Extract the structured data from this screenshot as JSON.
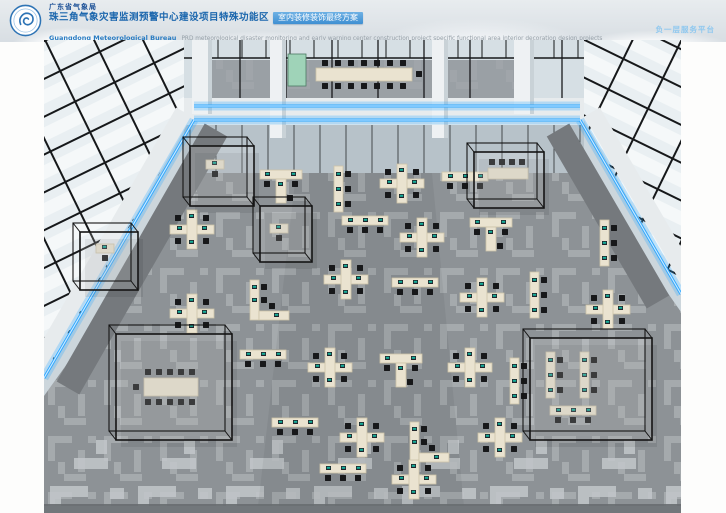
{
  "header": {
    "org": "广东省气象局",
    "title": "珠三角气象灾害监测预警中心建设项目特殊功能区",
    "title_tag": "室内装修装饰最终方案",
    "subtitle_bold": "Guangdong Meteorological Bureau",
    "subtitle_rest": "PRD meteorological disaster monitoring and early warning center construction project specific functional area interior decoration design projects",
    "page_label": "负一层服务平台"
  },
  "colors": {
    "sky1": "#e8ecef",
    "sky2": "#d8dee3",
    "org_blue": "#1a4f96",
    "title_blue": "#1b66ad",
    "tag_bg1": "#6fb1e4",
    "tag_bg2": "#3f8fd2",
    "tag_text": "#ffffff",
    "eng_blue": "#2a7cc2",
    "eng_gray": "#96a0a8",
    "page_label": "#8fc8ef",
    "glass_bg": "#ccd6dc",
    "glass_light": "#e9eff2",
    "railing": "#d6dfe4",
    "wall_glass": "#b7c2c9",
    "frame": "#16181a",
    "fascia": "#e7ebed",
    "walkway": "#75797d",
    "floor": "#8d9296",
    "floor_pattern": "#c2c7ca",
    "mezz_floor": "#9aa0a5",
    "column": "#eef1f3",
    "column_shade": "#c9d2d7",
    "led": "#2fa8ff",
    "led_hi": "#cfeaff",
    "desk": "#eae3d0",
    "desk_edge": "#cdc4a9",
    "chair": "#17181a",
    "screen": "#16ae9a",
    "display_panel": "#9fd3b8",
    "room_frame": "#141414",
    "bottom_edge": "#686d70"
  },
  "scene": {
    "size": {
      "w": 637,
      "h": 473
    },
    "left_wall": "0,0 172,0 150,72 0,338",
    "right_wall": "500,0 637,0 637,252 536,73",
    "mezzanine": {
      "rail": {
        "x": 140,
        "y": 0,
        "w": 400,
        "h": 66
      },
      "floor": {
        "x": 150,
        "y": 20,
        "w": 340,
        "h": 44
      },
      "lower_wall": {
        "x": 140,
        "y": 85,
        "w": 400,
        "h": 48
      },
      "fascia": {
        "x": 140,
        "y": 58,
        "w": 400,
        "h": 30
      },
      "table": {
        "x": 272,
        "y": 28,
        "w": 96,
        "h": 13
      },
      "display": {
        "x": 244,
        "y": 14,
        "w": 18,
        "h": 32
      },
      "columns": [
        {
          "x": 148,
          "y": 0,
          "w": 20,
          "h": 74
        },
        {
          "x": 226,
          "y": 0,
          "w": 16,
          "h": 98
        },
        {
          "x": 388,
          "y": 0,
          "w": 16,
          "h": 98
        },
        {
          "x": 470,
          "y": 0,
          "w": 20,
          "h": 74
        }
      ]
    },
    "floor_poly": "160,133 540,133 637,272 637,466 0,466 0,356",
    "bottom_band": "0,400 637,400 637,466 0,466",
    "aisle": "252,133 388,133 420,466 214,466",
    "walkways": [
      {
        "d": "M172,90 L24,348"
      },
      {
        "d": "M514,90 L614,262"
      }
    ],
    "fascia_paths": [
      {
        "d": "M140,72 L-8,330"
      },
      {
        "d": "M548,72 L648,244"
      }
    ],
    "led_strips": [
      {
        "d": "M150,66 L536,66"
      },
      {
        "d": "M150,80 L536,80"
      },
      {
        "d": "M150,80 L0,338"
      },
      {
        "d": "M536,80 L637,254"
      }
    ],
    "glass_rooms": [
      {
        "x": 146,
        "y": 106,
        "w": 64,
        "h": 60
      },
      {
        "x": 216,
        "y": 166,
        "w": 52,
        "h": 56
      },
      {
        "x": 72,
        "y": 294,
        "w": 116,
        "h": 106
      },
      {
        "x": 486,
        "y": 298,
        "w": 122,
        "h": 102
      },
      {
        "x": 430,
        "y": 112,
        "w": 70,
        "h": 56
      },
      {
        "x": 36,
        "y": 192,
        "w": 58,
        "h": 58
      }
    ],
    "cluster_types": {
      "cross": {
        "desks": [
          [
            0,
            15,
            44,
            9
          ],
          [
            17,
            0,
            10,
            39
          ]
        ],
        "chairs": [
          [
            8,
            8
          ],
          [
            36,
            8
          ],
          [
            8,
            31
          ],
          [
            36,
            31
          ]
        ],
        "monitors": [
          [
            7,
            16
          ],
          [
            32,
            16
          ],
          [
            19,
            4
          ],
          [
            19,
            30
          ]
        ]
      },
      "hrow": {
        "desks": [
          [
            0,
            0,
            46,
            9
          ]
        ],
        "chairs": [
          [
            8,
            14
          ],
          [
            23,
            14
          ],
          [
            38,
            14
          ]
        ],
        "monitors": [
          [
            6,
            2
          ],
          [
            21,
            2
          ],
          [
            36,
            2
          ]
        ]
      },
      "vrow": {
        "desks": [
          [
            0,
            0,
            9,
            46
          ]
        ],
        "chairs": [
          [
            14,
            8
          ],
          [
            14,
            23
          ],
          [
            14,
            38
          ]
        ],
        "monitors": [
          [
            2,
            6
          ],
          [
            2,
            21
          ],
          [
            2,
            36
          ]
        ]
      },
      "trow": {
        "desks": [
          [
            0,
            0,
            42,
            9
          ],
          [
            16,
            9,
            10,
            24
          ]
        ],
        "chairs": [
          [
            7,
            14
          ],
          [
            35,
            14
          ],
          [
            30,
            28
          ]
        ],
        "monitors": [
          [
            5,
            2
          ],
          [
            31,
            2
          ],
          [
            18,
            12
          ]
        ]
      },
      "lshape": {
        "desks": [
          [
            0,
            0,
            9,
            40
          ],
          [
            9,
            31,
            30,
            9
          ]
        ],
        "chairs": [
          [
            14,
            7
          ],
          [
            14,
            20
          ],
          [
            22,
            26
          ]
        ],
        "monitors": [
          [
            2,
            5
          ],
          [
            2,
            18
          ],
          [
            24,
            33
          ]
        ]
      },
      "single": {
        "desks": [
          [
            0,
            0,
            18,
            9
          ]
        ],
        "chairs": [
          [
            9,
            14
          ]
        ],
        "monitors": [
          [
            6,
            1
          ]
        ]
      },
      "conference": {
        "desks": [
          [
            0,
            0,
            54,
            18
          ]
        ],
        "chairs": [
          [
            4,
            -6
          ],
          [
            15,
            -6
          ],
          [
            26,
            -6
          ],
          [
            37,
            -6
          ],
          [
            48,
            -6
          ],
          [
            4,
            24
          ],
          [
            15,
            24
          ],
          [
            26,
            24
          ],
          [
            37,
            24
          ],
          [
            48,
            24
          ],
          [
            -8,
            9
          ]
        ],
        "monitors": []
      },
      "smallconf": {
        "desks": [
          [
            0,
            0,
            40,
            11
          ]
        ],
        "chairs": [
          [
            4,
            -6
          ],
          [
            14,
            -6
          ],
          [
            24,
            -6
          ],
          [
            34,
            -6
          ]
        ],
        "monitors": []
      }
    },
    "desk_clusters": [
      {
        "t": "single",
        "x": 162,
        "y": 120
      },
      {
        "t": "trow",
        "x": 216,
        "y": 130
      },
      {
        "t": "vrow",
        "x": 290,
        "y": 126
      },
      {
        "t": "cross",
        "x": 336,
        "y": 124
      },
      {
        "t": "hrow",
        "x": 398,
        "y": 132
      },
      {
        "t": "cross",
        "x": 126,
        "y": 170
      },
      {
        "t": "single",
        "x": 226,
        "y": 184
      },
      {
        "t": "hrow",
        "x": 298,
        "y": 176
      },
      {
        "t": "cross",
        "x": 356,
        "y": 178
      },
      {
        "t": "trow",
        "x": 426,
        "y": 178
      },
      {
        "t": "vrow",
        "x": 556,
        "y": 180
      },
      {
        "t": "cross",
        "x": 280,
        "y": 220
      },
      {
        "t": "lshape",
        "x": 206,
        "y": 240
      },
      {
        "t": "cross",
        "x": 126,
        "y": 254
      },
      {
        "t": "hrow",
        "x": 348,
        "y": 238
      },
      {
        "t": "cross",
        "x": 416,
        "y": 238
      },
      {
        "t": "vrow",
        "x": 486,
        "y": 232
      },
      {
        "t": "cross",
        "x": 542,
        "y": 250
      },
      {
        "t": "hrow",
        "x": 196,
        "y": 310
      },
      {
        "t": "cross",
        "x": 264,
        "y": 308
      },
      {
        "t": "trow",
        "x": 336,
        "y": 314
      },
      {
        "t": "cross",
        "x": 404,
        "y": 308
      },
      {
        "t": "vrow",
        "x": 466,
        "y": 318
      },
      {
        "t": "hrow",
        "x": 228,
        "y": 378
      },
      {
        "t": "cross",
        "x": 296,
        "y": 378
      },
      {
        "t": "lshape",
        "x": 366,
        "y": 382
      },
      {
        "t": "cross",
        "x": 434,
        "y": 378
      },
      {
        "t": "hrow",
        "x": 276,
        "y": 424
      },
      {
        "t": "cross",
        "x": 348,
        "y": 420
      },
      {
        "t": "single",
        "x": 52,
        "y": 204
      },
      {
        "t": "conference",
        "x": 100,
        "y": 338
      },
      {
        "t": "smallconf",
        "x": 444,
        "y": 128
      },
      {
        "t": "vrow",
        "x": 502,
        "y": 312
      },
      {
        "t": "vrow",
        "x": 536,
        "y": 312
      },
      {
        "t": "hrow",
        "x": 506,
        "y": 366
      }
    ],
    "bottom_edge": {
      "x": 0,
      "y": 464,
      "w": 637,
      "h": 9
    }
  }
}
